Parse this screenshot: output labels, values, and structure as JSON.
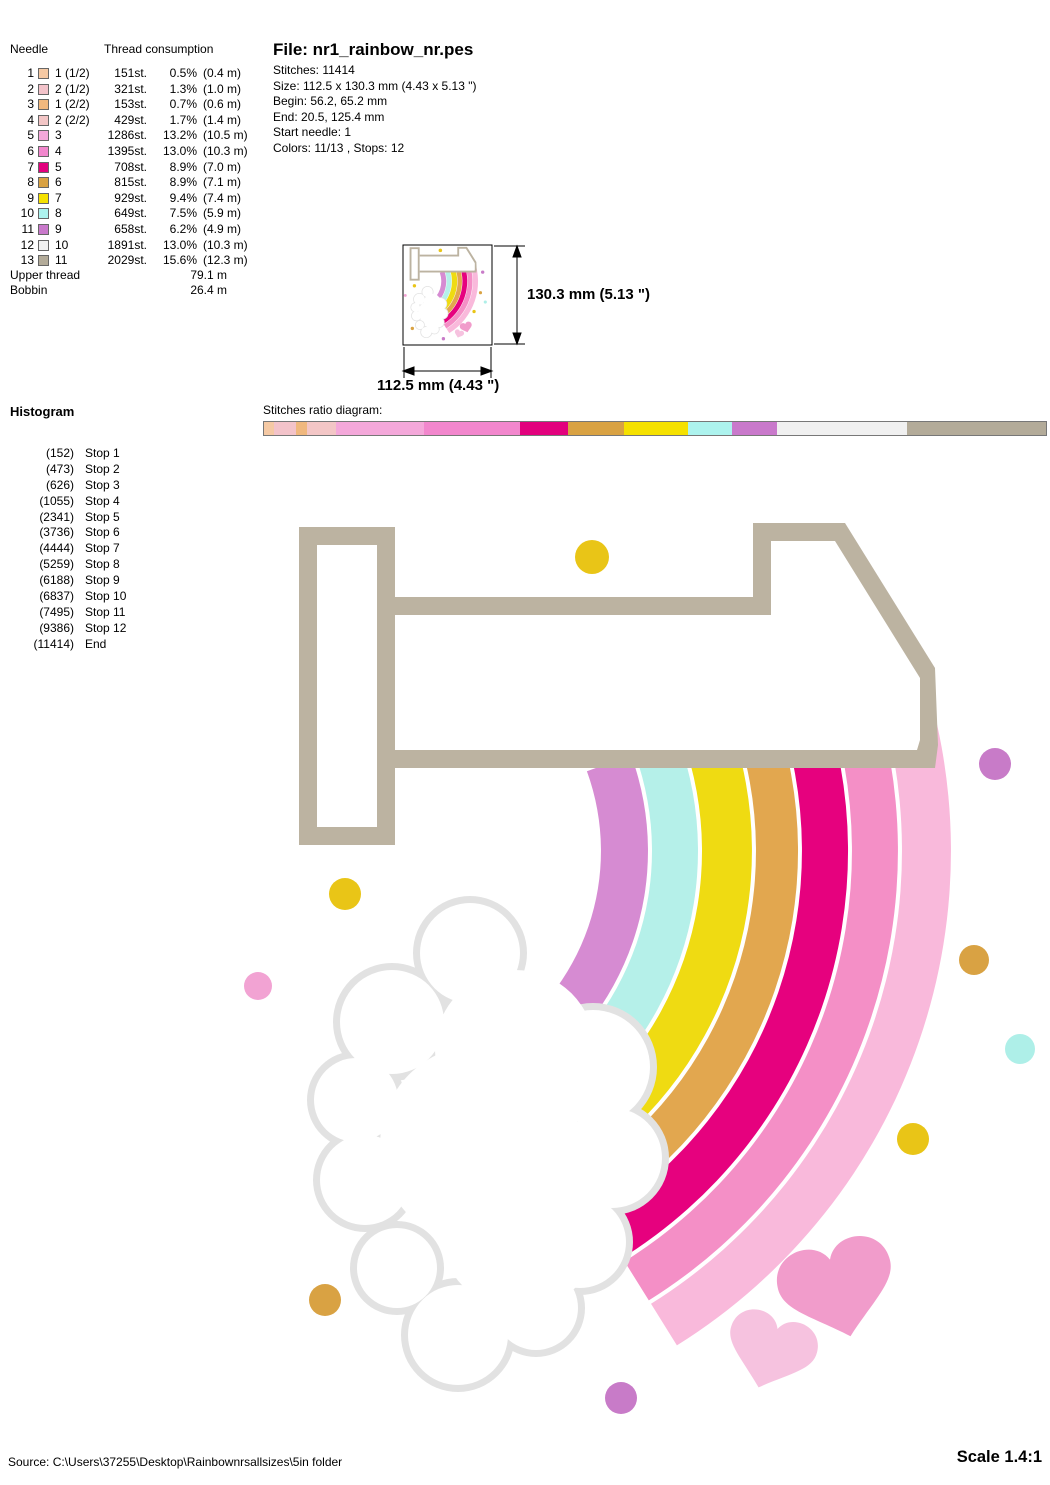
{
  "file_info": {
    "title": "File: nr1_rainbow_nr.pes",
    "lines": [
      "Stitches: 11414",
      "Size: 112.5 x 130.3 mm (4.43 x 5.13 \")",
      "Begin: 56.2, 65.2 mm",
      "End: 20.5, 125.4 mm",
      "Start needle: 1",
      "Colors: 11/13 , Stops: 12"
    ]
  },
  "needle_table": {
    "header_needle": "Needle",
    "header_consumption": "Thread consumption",
    "rows": [
      {
        "n": "1",
        "color": "#F5C9A4",
        "code": "1 (1/2)",
        "st": "151st.",
        "pct": "0.5%",
        "len": "(0.4 m)"
      },
      {
        "n": "2",
        "color": "#F3C3CA",
        "code": "2 (1/2)",
        "st": "321st.",
        "pct": "1.3%",
        "len": "(1.0 m)"
      },
      {
        "n": "3",
        "color": "#F0B87E",
        "code": "1 (2/2)",
        "st": "153st.",
        "pct": "0.7%",
        "len": "(0.6 m)"
      },
      {
        "n": "4",
        "color": "#F3C6C6",
        "code": "2 (2/2)",
        "st": "429st.",
        "pct": "1.7%",
        "len": "(1.4 m)"
      },
      {
        "n": "5",
        "color": "#F4A8DA",
        "code": "3",
        "st": "1286st.",
        "pct": "13.2%",
        "len": "(10.5 m)"
      },
      {
        "n": "6",
        "color": "#F287CD",
        "code": "4",
        "st": "1395st.",
        "pct": "13.0%",
        "len": "(10.3 m)"
      },
      {
        "n": "7",
        "color": "#E2017D",
        "code": "5",
        "st": "708st.",
        "pct": "8.9%",
        "len": "(7.0 m)"
      },
      {
        "n": "8",
        "color": "#D9A243",
        "code": "6",
        "st": "815st.",
        "pct": "8.9%",
        "len": "(7.1 m)"
      },
      {
        "n": "9",
        "color": "#F5E100",
        "code": "7",
        "st": "929st.",
        "pct": "9.4%",
        "len": "(7.4 m)"
      },
      {
        "n": "10",
        "color": "#ADF3EE",
        "code": "8",
        "st": "649st.",
        "pct": "7.5%",
        "len": "(5.9 m)"
      },
      {
        "n": "11",
        "color": "#C979CB",
        "code": "9",
        "st": "658st.",
        "pct": "6.2%",
        "len": "(4.9 m)"
      },
      {
        "n": "12",
        "color": "#F0F0F0",
        "code": "10",
        "st": "1891st.",
        "pct": "13.0%",
        "len": "(10.3 m)"
      },
      {
        "n": "13",
        "color": "#B3AB99",
        "code": "11",
        "st": "2029st.",
        "pct": "15.6%",
        "len": "(12.3 m)"
      }
    ],
    "upper_label": "Upper thread",
    "upper_value": "79.1 m",
    "bobbin_label": "Bobbin",
    "bobbin_value": "26.4 m"
  },
  "histogram": {
    "title": "Histogram",
    "items": [
      {
        "count": "(152)",
        "label": "Stop 1"
      },
      {
        "count": "(473)",
        "label": "Stop 2"
      },
      {
        "count": "(626)",
        "label": "Stop 3"
      },
      {
        "count": "(1055)",
        "label": "Stop 4"
      },
      {
        "count": "(2341)",
        "label": "Stop 5"
      },
      {
        "count": "(3736)",
        "label": "Stop 6"
      },
      {
        "count": "(4444)",
        "label": "Stop 7"
      },
      {
        "count": "(5259)",
        "label": "Stop 8"
      },
      {
        "count": "(6188)",
        "label": "Stop 9"
      },
      {
        "count": "(6837)",
        "label": "Stop 10"
      },
      {
        "count": "(7495)",
        "label": "Stop 11"
      },
      {
        "count": "(9386)",
        "label": "Stop 12"
      },
      {
        "count": "(11414)",
        "label": "End"
      }
    ]
  },
  "ratio": {
    "label": "Stitches ratio diagram:",
    "total_stitches": 11414,
    "segments": [
      {
        "needle": 1,
        "color": "#F5C9A4",
        "stitches": 151
      },
      {
        "needle": 2,
        "color": "#F3C3CA",
        "stitches": 321
      },
      {
        "needle": 3,
        "color": "#F0B87E",
        "stitches": 153
      },
      {
        "needle": 4,
        "color": "#F3C6C6",
        "stitches": 429
      },
      {
        "needle": 5,
        "color": "#F4A8DA",
        "stitches": 1286
      },
      {
        "needle": 6,
        "color": "#F287CD",
        "stitches": 1395
      },
      {
        "needle": 7,
        "color": "#E2017D",
        "stitches": 708
      },
      {
        "needle": 8,
        "color": "#D9A243",
        "stitches": 815
      },
      {
        "needle": 9,
        "color": "#F5E100",
        "stitches": 929
      },
      {
        "needle": 10,
        "color": "#ADF3EE",
        "stitches": 649
      },
      {
        "needle": 11,
        "color": "#C979CB",
        "stitches": 658
      },
      {
        "needle": 12,
        "color": "#F0F0F0",
        "stitches": 1891
      },
      {
        "needle": 13,
        "color": "#B3AB99",
        "stitches": 2029
      }
    ]
  },
  "dimensions": {
    "height_label": "130.3 mm (5.13 \")",
    "width_label": "112.5 mm (4.43 \")"
  },
  "footer": {
    "source": "Source: C:\\Users\\37255\\Desktop\\Rainbownrsallsizes\\5in folder",
    "scale": "Scale 1.4:1"
  },
  "design": {
    "numeral_color": "#BCB3A1",
    "cloud_edge": "#E2E2E2",
    "rainbow": [
      "#D68BD2",
      "#B5F0E9",
      "#EFDB12",
      "#E2A74F",
      "#E6017E",
      "#F48FC6",
      "#F9B9DB"
    ],
    "hearts": [
      "#F19CCB",
      "#F6C2DF"
    ],
    "dots": {
      "gold": "#E9C517",
      "orchid": "#C87BC8",
      "tan": "#D9A243",
      "cyan": "#AEEFE8",
      "pink": "#F2A3D3"
    }
  }
}
